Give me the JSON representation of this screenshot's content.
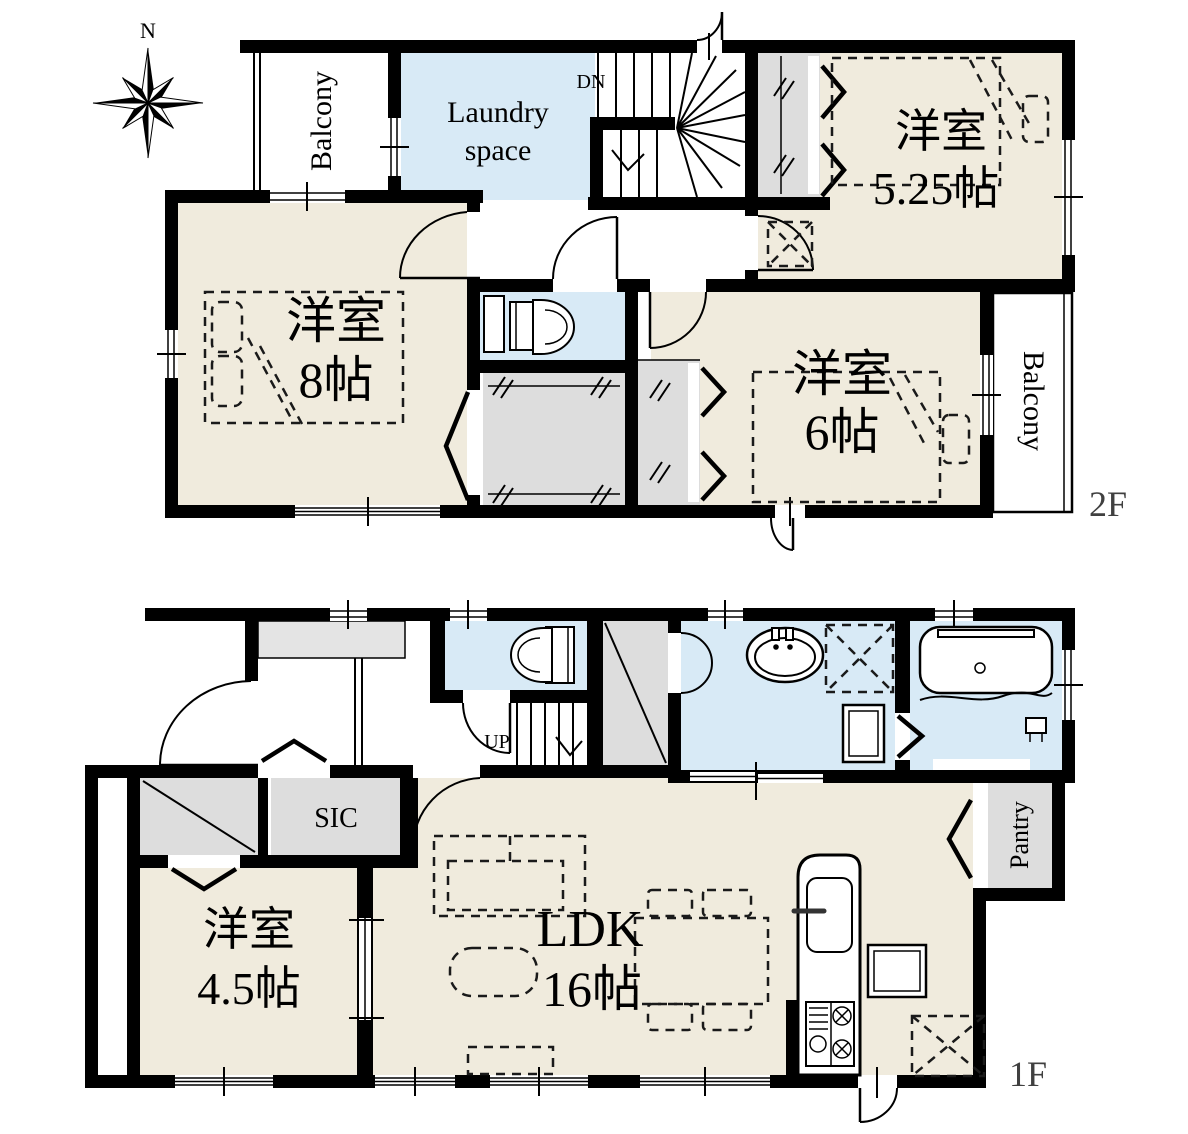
{
  "compass": {
    "north_label": "N"
  },
  "floor_2f": {
    "floor_label": "2F",
    "balcony_left": "Balcony",
    "balcony_right": "Balcony",
    "laundry_line1": "Laundry",
    "laundry_line2": "space",
    "stairs_label": "DN",
    "room_525": {
      "name": "洋室",
      "size": "5.25帖"
    },
    "room_8": {
      "name": "洋室",
      "size": "8帖"
    },
    "room_6": {
      "name": "洋室",
      "size": "6帖"
    }
  },
  "floor_1f": {
    "floor_label": "1F",
    "sic_label": "SIC",
    "pantry_label": "Pantry",
    "stairs_label": "UP",
    "room_45": {
      "name": "洋室",
      "size": "4.5帖"
    },
    "ldk": {
      "name": "LDK",
      "size": "16帖"
    }
  },
  "colors": {
    "room_beige": "#F0EBDD",
    "water_blue": "#D8EAF6",
    "closet_gray": "#DDDDDD",
    "wall_black": "#000000",
    "floor_label_gray": "#404040"
  }
}
